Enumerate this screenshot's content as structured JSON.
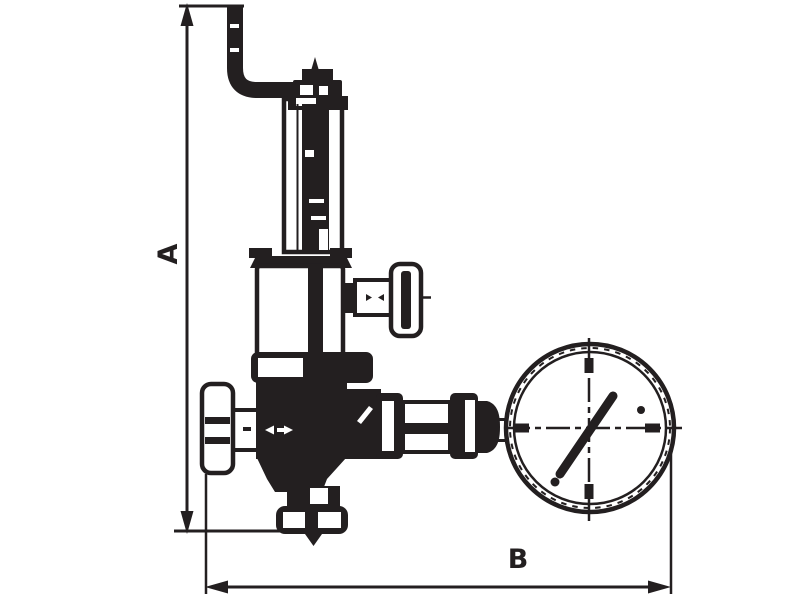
{
  "diagram": {
    "type": "technical-line-drawing",
    "subject": "pressure reducing valve with overflow pipe and pressure gauge, dimensioned side view",
    "background_color": "#ffffff",
    "line_color": "#231f20",
    "dimensions": {
      "vertical_label": "A",
      "horizontal_label": "B"
    },
    "components": [
      "overflow-pipe",
      "adjusting-cap",
      "spring-housing",
      "bonnet",
      "side-tap-handwheel",
      "hex-flange",
      "valve-body",
      "inlet-handwheel",
      "outlet-cone",
      "bottom-union",
      "gauge-piping",
      "pressure-gauge"
    ]
  }
}
